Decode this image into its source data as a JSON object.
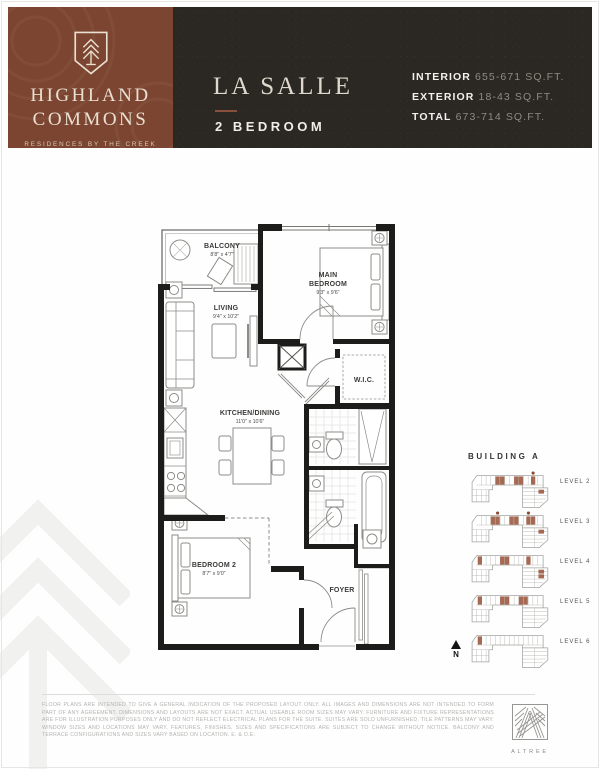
{
  "header": {
    "brand": {
      "name_line1": "HIGHLAND",
      "name_line2": "COMMONS",
      "tagline": "RESIDENCES BY THE CREEK"
    },
    "plan_name": "LA SALLE",
    "plan_type": "2 BEDROOM",
    "stats": [
      {
        "label": "INTERIOR",
        "value": "655-671 SQ.FT."
      },
      {
        "label": "EXTERIOR",
        "value": "18-43 SQ.FT."
      },
      {
        "label": "TOTAL",
        "value": "673-714 SQ.FT."
      }
    ]
  },
  "floorplan": {
    "rooms": {
      "balcony": {
        "name": "BALCONY",
        "dims": "8'8\" x 4'7\""
      },
      "living": {
        "name": "LIVING",
        "dims": "9'4\" x 10'2\""
      },
      "main_bedroom": {
        "line1": "MAIN",
        "line2": "BEDROOM",
        "dims": "9'3\" x 9'6\""
      },
      "wic": {
        "name": "W.I.C."
      },
      "kitchen": {
        "name": "KITCHEN/DINING",
        "dims": "11'0\" x 10'6\""
      },
      "bedroom2": {
        "name": "BEDROOM 2",
        "dims": "8'7\" x 9'0\""
      },
      "foyer": {
        "name": "FOYER"
      }
    }
  },
  "keyplans": {
    "title": "BUILDING A",
    "north_label": "N",
    "levels": [
      {
        "label": "LEVEL 2",
        "cells": [
          33,
          38,
          53,
          58,
          71
        ],
        "wing_cells": [
          [
            79,
            20
          ]
        ],
        "dots": [
          71
        ]
      },
      {
        "label": "LEVEL 3",
        "cells": [
          28,
          33,
          48,
          53,
          66,
          71
        ],
        "wing_cells": [
          [
            79,
            20
          ]
        ],
        "dots": [
          33,
          66
        ]
      },
      {
        "label": "LEVEL 4",
        "cells": [
          14,
          38,
          43,
          66
        ],
        "wing_cells": [
          [
            79,
            20
          ],
          [
            79,
            25
          ]
        ],
        "dots": []
      },
      {
        "label": "LEVEL 5",
        "cells": [
          14,
          38,
          43,
          58,
          63
        ],
        "wing_cells": [],
        "dots": []
      },
      {
        "label": "LEVEL 6",
        "cells": [
          14
        ],
        "wing_cells": [],
        "dots": []
      }
    ]
  },
  "footer": {
    "disclaimer": "Floor plans are intended to give a general indication of the proposed layout only. All images and dimensions are not intended to form part of any agreement. Dimensions and layouts are not exact. Actual useable room sizes may vary. Furniture and fixture representations are for illustration purposes only and do not reflect electrical plans for the suite. Suites are sold unfurnished. Tile patterns may vary. Window sizes and locations may vary. Features, finishes, sizes and specifications are subject to change without notice. Balcony and terrace configurations and sizes vary based on location. E. & O.E.",
    "logo_text": "ALTREE"
  },
  "colors": {
    "brand_rust": "#7c4531",
    "header_dark": "#2b2824",
    "cream": "#e9e0d1",
    "unit_highlight": "#9c5a41",
    "watermark": "#f1f1ef"
  }
}
